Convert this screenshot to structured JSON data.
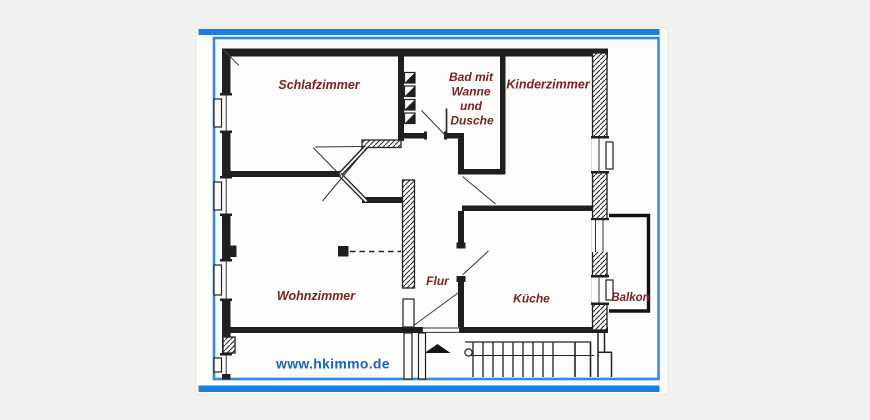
{
  "image": {
    "description": "Hand-drawn apartment floor plan photo with blue frame stripes",
    "colors": {
      "page_background": "#f1f1f0",
      "photo_background": "#fdfdfb",
      "frame_blue": "#1b7de0",
      "frame_blue_light": "#2e8ae2",
      "watermark_blue": "#1565c6",
      "room_label": "#7b2121",
      "wall_ink": "#1f1f1f"
    }
  },
  "rooms": {
    "schlafzimmer": {
      "label": "Schlafzimmer"
    },
    "bad": {
      "line1": "Bad mit",
      "line2": "Wanne",
      "line3": "und",
      "line4": "Dusche"
    },
    "kinderzimmer": {
      "label": "Kinderzimmer"
    },
    "wohnzimmer": {
      "label": "Wohnzimmer"
    },
    "flur": {
      "label": "Flur"
    },
    "kueche": {
      "label": "Küche"
    },
    "balkon": {
      "label": "Balkon"
    }
  },
  "watermark": {
    "text": "www.hkimmo.de"
  }
}
